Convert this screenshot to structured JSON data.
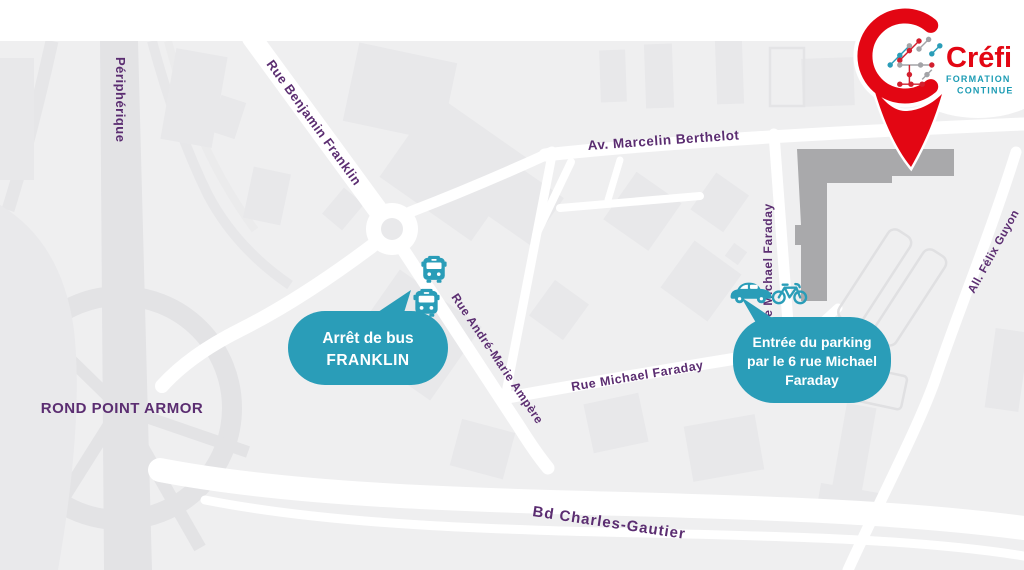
{
  "logo": {
    "brand": "Créfi",
    "tagline1": "FORMATION",
    "tagline2": "CONTINUE"
  },
  "map": {
    "streets": {
      "peripherique": "Périphérique",
      "benjamin_franklin": "Rue Benjamin Franklin",
      "marcelin_berthelot": "Av. Marcelin Berthelot",
      "michael_faraday_v": "Rue Michael Faraday",
      "andre_marie_ampere": "Rue André-Marie Ampère",
      "michael_faraday_h": "Rue Michael Faraday",
      "felix_guyon": "All. Félix Guyon",
      "charles_gautier": "Bd Charles-Gautier",
      "rond_point_armor": "ROND POINT ARMOR"
    },
    "callouts": {
      "bus_stop": {
        "line1": "Arrêt de bus",
        "line2": "FRANKLIN",
        "icons": [
          "bus-icon",
          "bus-icon"
        ]
      },
      "parking": {
        "line1": "Entrée du parking",
        "line2": "par le 6 rue Michael",
        "line3": "Faraday",
        "icons": [
          "car-icon",
          "bike-icon"
        ]
      }
    },
    "colors": {
      "background": "#efeff0",
      "road": "#ffffff",
      "building": "#e8e8ea",
      "major_road": "#e3e3e5",
      "street_label": "#5b2d71",
      "callout_teal": "#2a9db8",
      "pin_red": "#e30613",
      "logo_teal": "#1d9cb4",
      "highlight_building": "#a9a9ab"
    }
  }
}
